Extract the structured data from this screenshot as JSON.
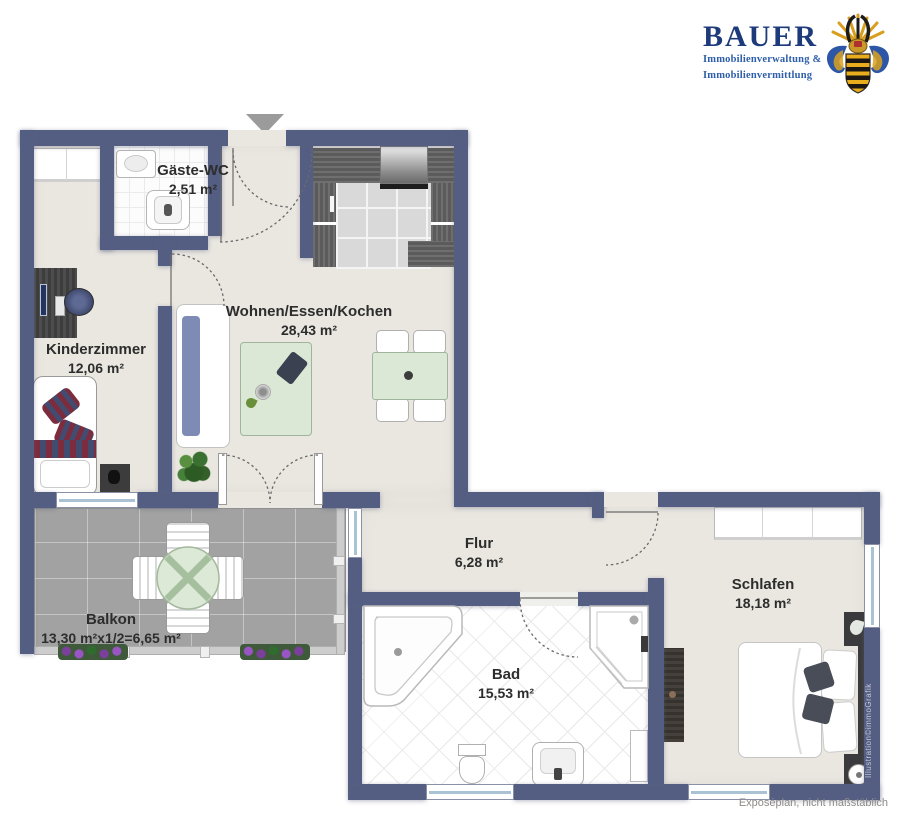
{
  "logo": {
    "title": "BAUER",
    "subtitle_line1": "Immobilienverwaltung &",
    "subtitle_line2": "Immobilienvermittlung",
    "crest_icon": "company-crest-icon",
    "title_color": "#1d3b7b",
    "subtitle_color": "#2e5ea9"
  },
  "rooms": {
    "gaeste_wc": {
      "name": "Gäste-WC",
      "area": "2,51 m²"
    },
    "wohnen": {
      "name": "Wohnen/Essen/Kochen",
      "area": "28,43 m²"
    },
    "kinderzimmer": {
      "name": "Kinderzimmer",
      "area": "12,06 m²"
    },
    "flur": {
      "name": "Flur",
      "area": "6,28 m²"
    },
    "bad": {
      "name": "Bad",
      "area": "15,53 m²"
    },
    "schlafen": {
      "name": "Schlafen",
      "area": "18,18 m²"
    },
    "balkon": {
      "name": "Balkon",
      "area": "13,30 m²x1/2=6,65 m²"
    }
  },
  "entry_marker": {
    "icon": "entrance-arrow-icon"
  },
  "footer": {
    "note": "Exposéplan, nicht maßstäblich"
  },
  "watermark": {
    "credit": "Illustration©immoGrafik"
  },
  "colors": {
    "wall": "#545e82",
    "floor": "#eae7e1",
    "balcony_tile": "#a2a2a2",
    "table_green": "#dbe8d5",
    "window_glass": "#a9c3d4"
  }
}
